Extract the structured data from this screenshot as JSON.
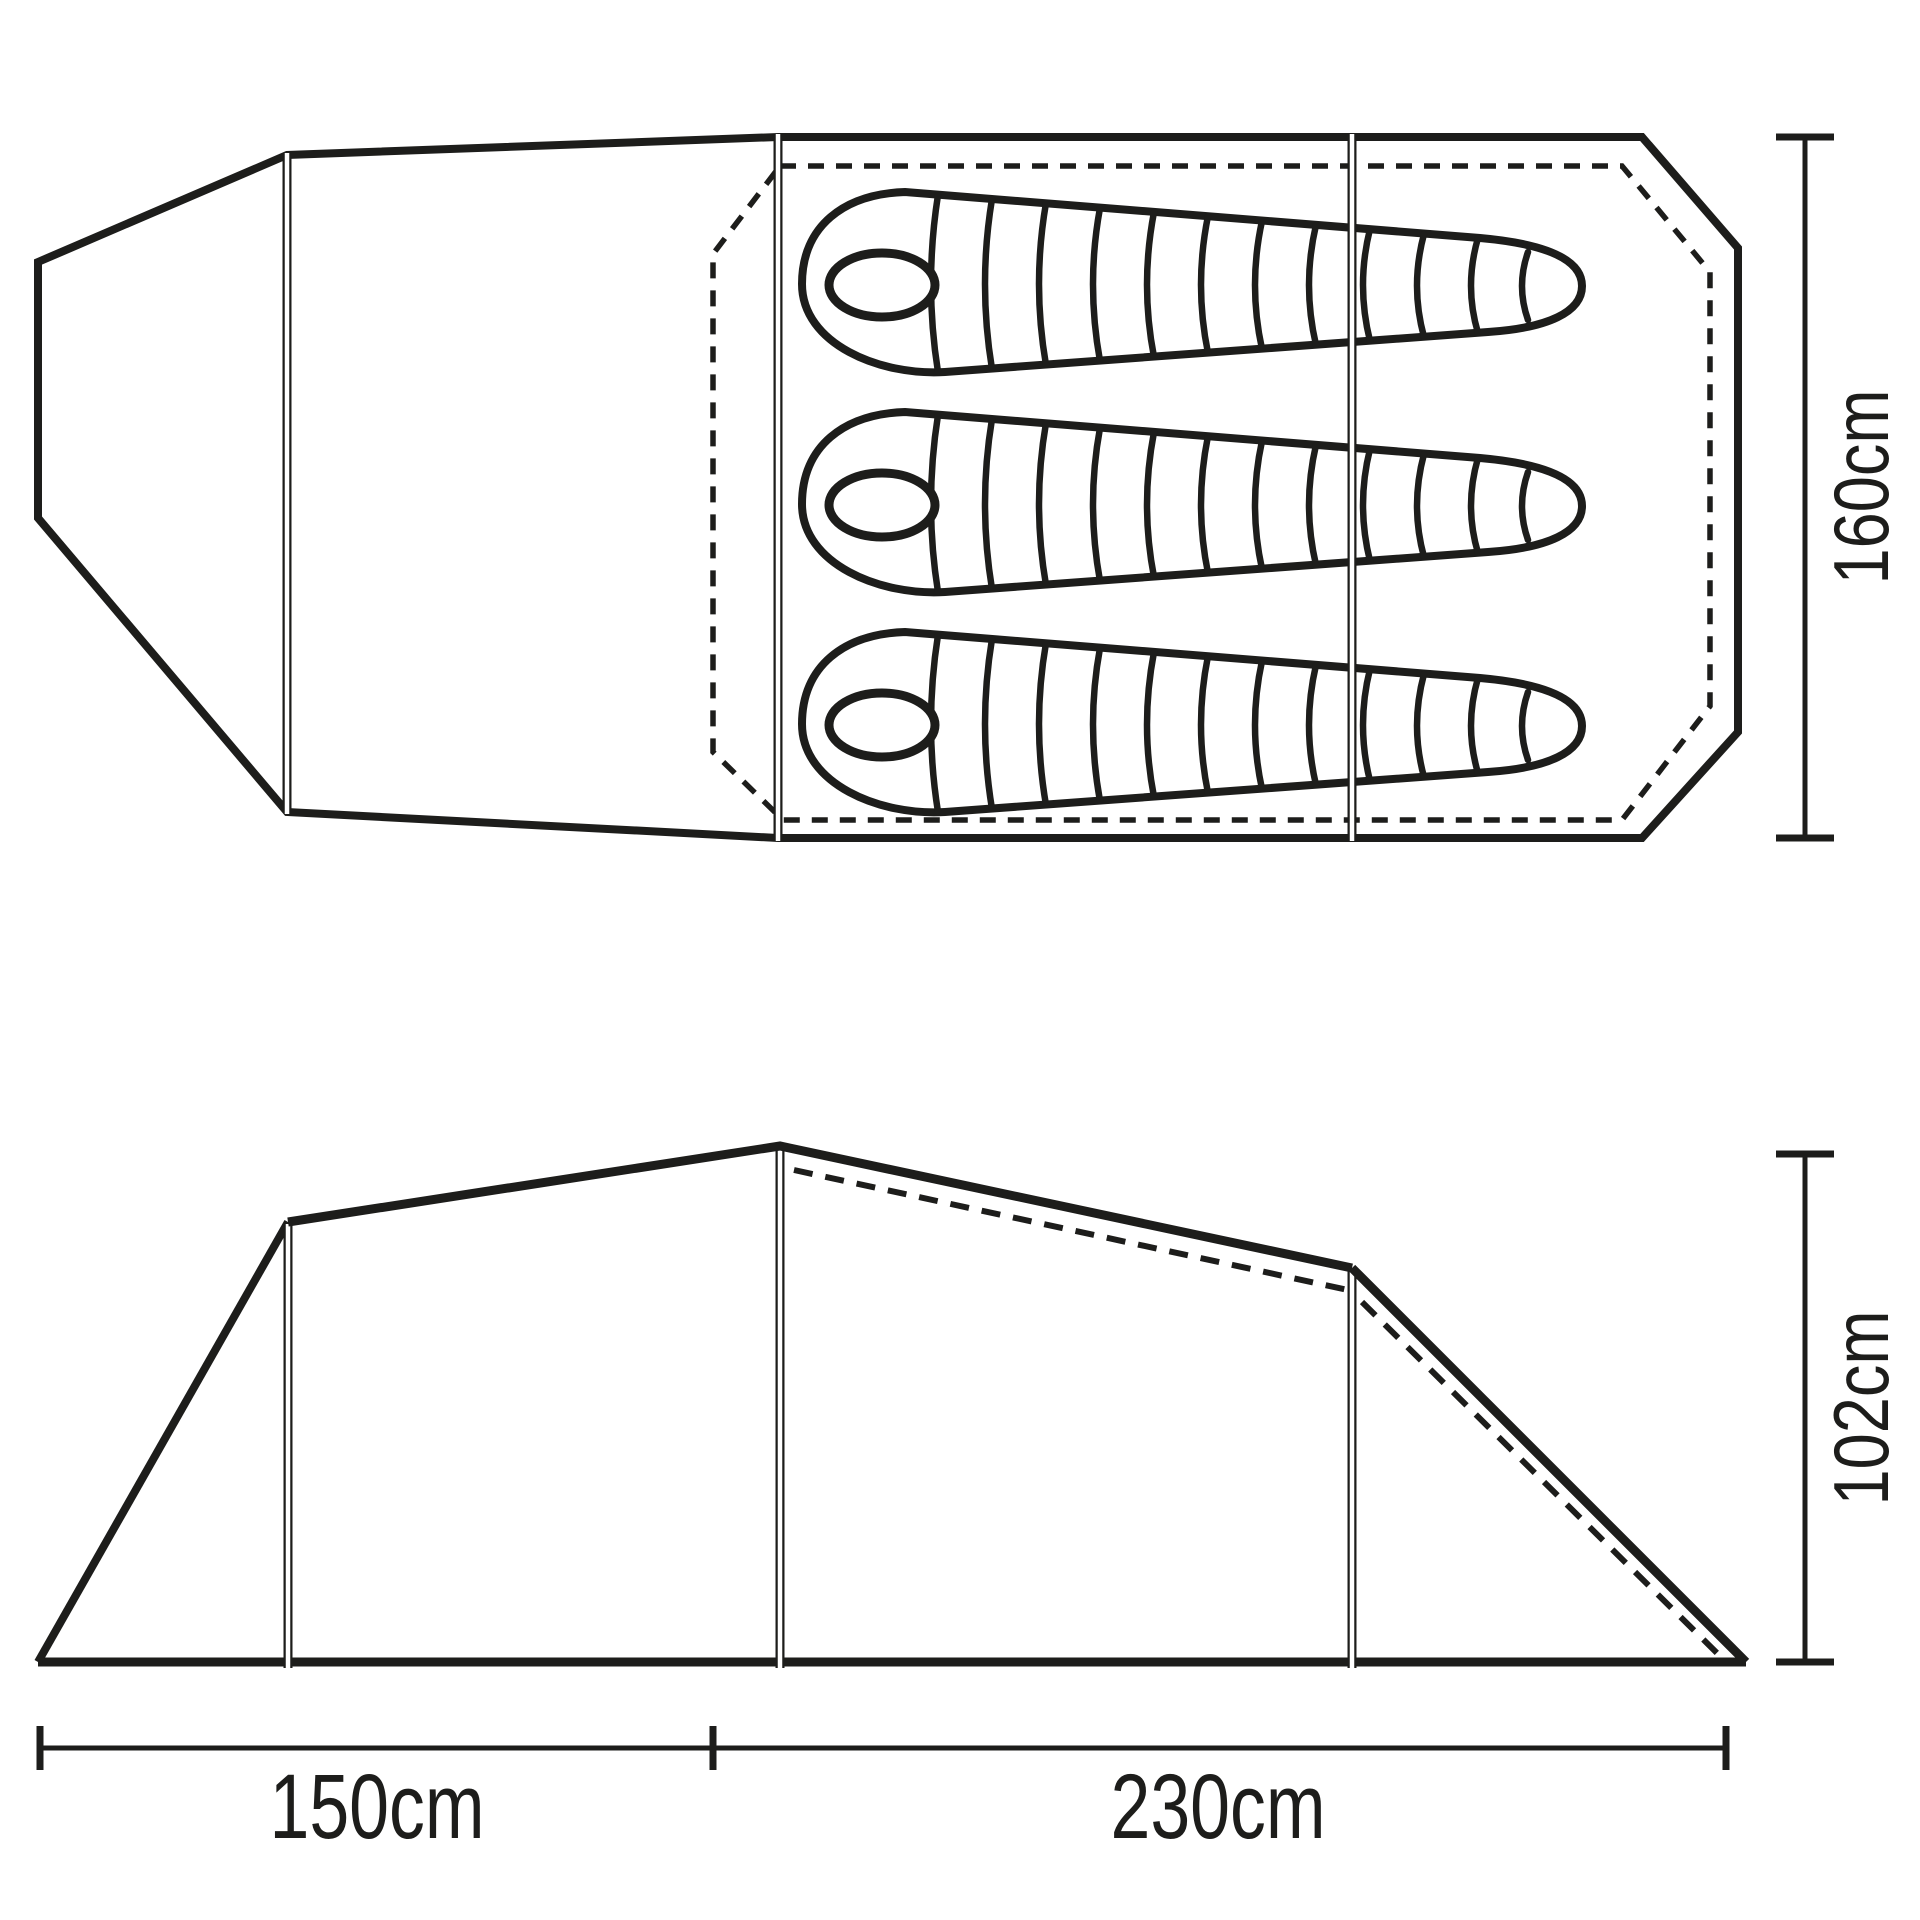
{
  "diagram": {
    "type": "tent-technical-drawing",
    "background_color": "#ffffff",
    "line_color": "#1d1d1b",
    "views": {
      "floor_plan": {
        "description": "tent floor plan top view",
        "sleeping_bag_count": "3"
      },
      "side_elevation": {
        "description": "tent side elevation view"
      }
    },
    "dimensions": {
      "inner_width": {
        "label": "160cm"
      },
      "peak_height": {
        "label": "102cm"
      },
      "porch_length": {
        "label": "150cm"
      },
      "inner_length": {
        "label": "230cm"
      }
    }
  }
}
